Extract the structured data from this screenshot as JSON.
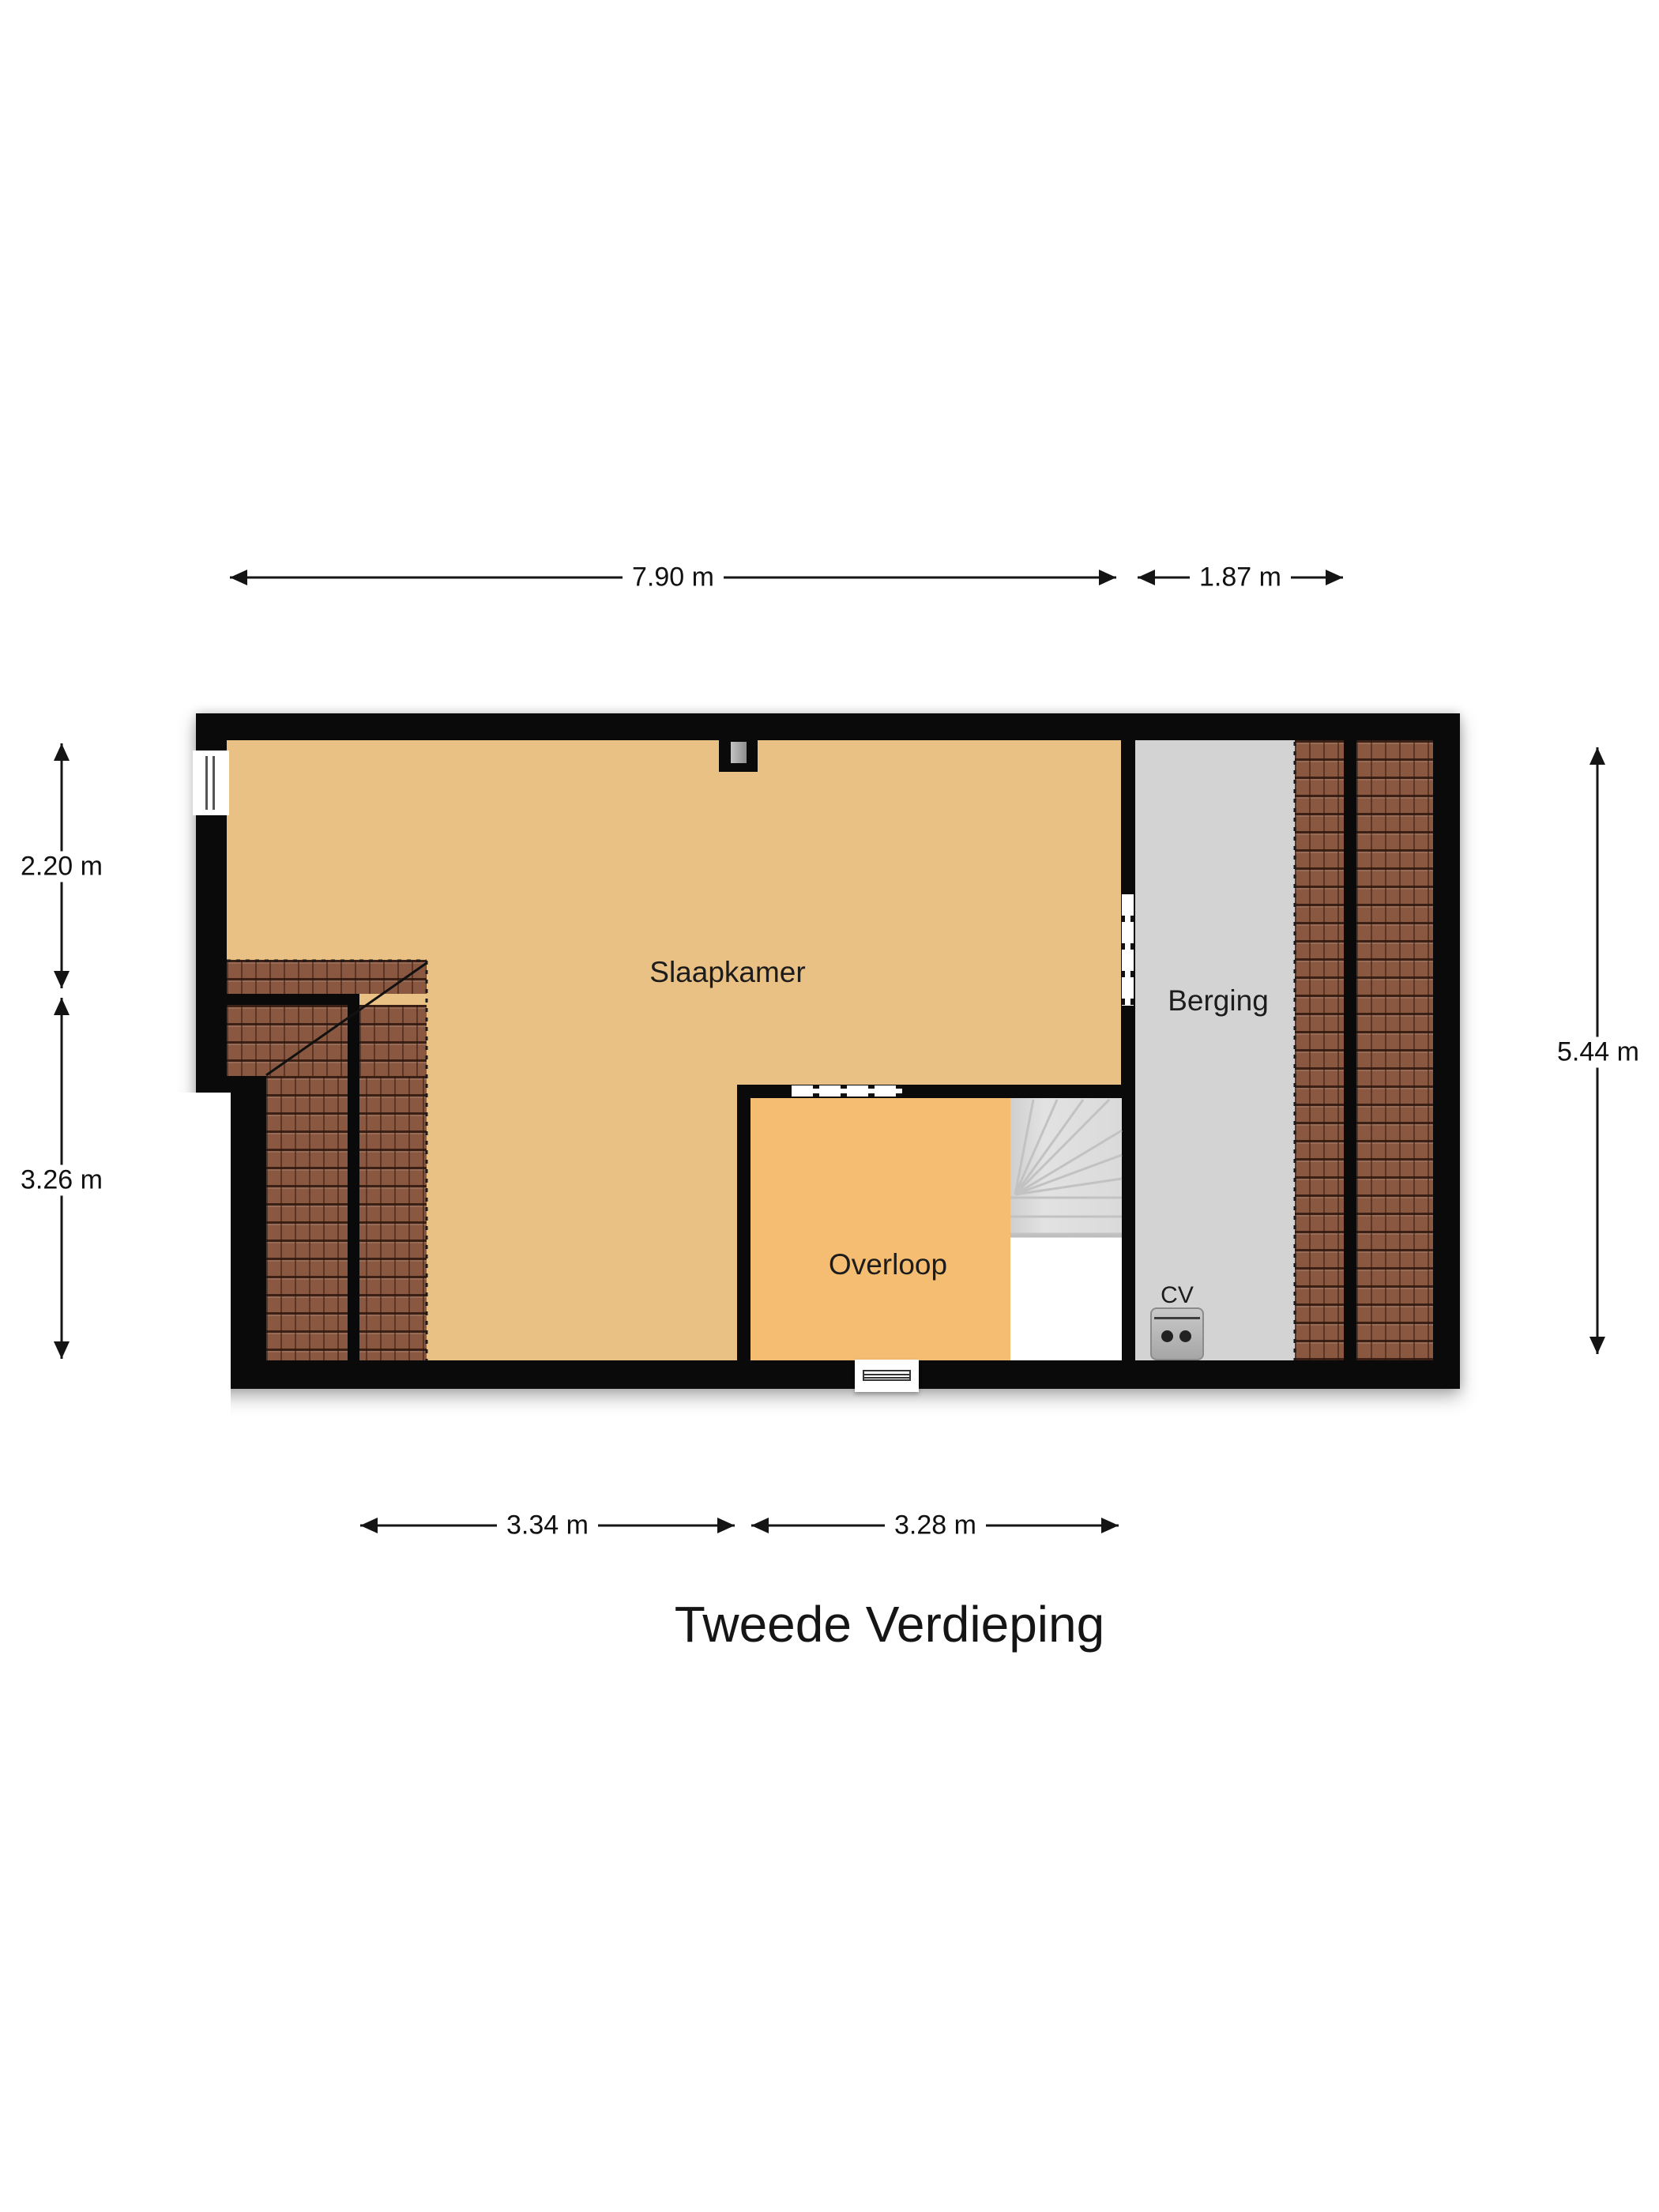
{
  "title": "Tweede Verdieping",
  "floorplan": {
    "rooms": [
      {
        "id": "slaapkamer",
        "label": "Slaapkamer"
      },
      {
        "id": "berging",
        "label": "Berging"
      },
      {
        "id": "overloop",
        "label": "Overloop"
      }
    ],
    "equipment": {
      "cv_label": "CV"
    },
    "dimensions": {
      "top": [
        {
          "label": "7.90 m"
        },
        {
          "label": "1.87 m"
        }
      ],
      "left": [
        {
          "label": "2.20 m"
        },
        {
          "label": "3.26 m"
        }
      ],
      "right": [
        {
          "label": "5.44 m"
        }
      ],
      "bottom": [
        {
          "label": "3.34 m"
        },
        {
          "label": "3.28 m"
        }
      ]
    },
    "colors": {
      "wall": "#0a0a0a",
      "bedroom_floor": "#e9c184",
      "landing_floor": "#f5bd72",
      "storage_floor": "#d3d3d3",
      "stairs": "#dadada",
      "roof_tile": "#8a5740",
      "background": "#ffffff"
    }
  }
}
